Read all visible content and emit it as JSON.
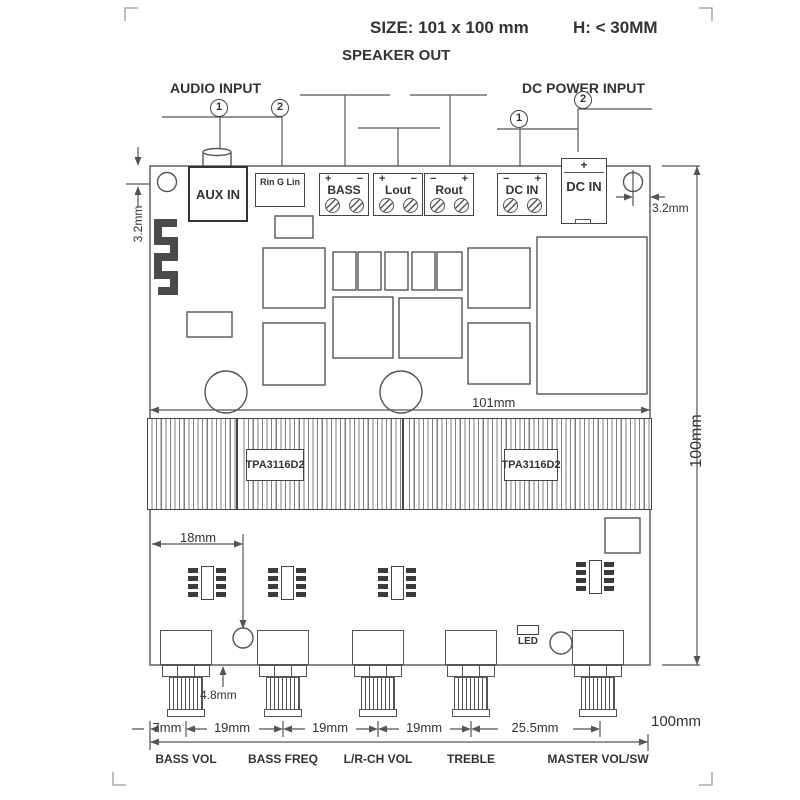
{
  "header": {
    "size_label": "SIZE:  101 x 100 mm",
    "height_label": "H:  < 30MM"
  },
  "groups": {
    "speaker_out": "SPEAKER  OUT",
    "audio_input": "AUDIO INPUT",
    "dc_power_input": "DC POWER INPUT"
  },
  "callouts": {
    "one": "1",
    "two": "2"
  },
  "connectors": {
    "aux_in": "AUX IN",
    "line_in": "Rin G Lin",
    "speaker_terminals": [
      {
        "label": "BASS",
        "left_sign": "+",
        "right_sign": "−"
      },
      {
        "label": "Lout",
        "left_sign": "+",
        "right_sign": "−"
      },
      {
        "label": "Rout",
        "left_sign": "−",
        "right_sign": "+"
      }
    ],
    "dc_terminal": {
      "label": "DC IN",
      "left_sign": "−",
      "right_sign": "+"
    },
    "dc_jack": {
      "label": "DC IN",
      "sign": "+"
    }
  },
  "chips": {
    "amp_left": "TPA3116D2",
    "amp_right": "TPA3116D2"
  },
  "led_label": "LED",
  "dimensions": {
    "hole_offset_left": "3.2mm",
    "hole_offset_right": "3.2mm",
    "board_width": "101mm",
    "board_height": "100mm",
    "pot_offset_x": "18mm",
    "pot_offset_y": "4.8mm",
    "spacing": [
      "7mm",
      "19mm",
      "19mm",
      "19mm",
      "25.5mm"
    ],
    "overall_width": "100mm"
  },
  "controls": [
    "BASS VOL",
    "BASS FREQ",
    "L/R-CH VOL",
    "TREBLE",
    "MASTER VOL/SW"
  ]
}
